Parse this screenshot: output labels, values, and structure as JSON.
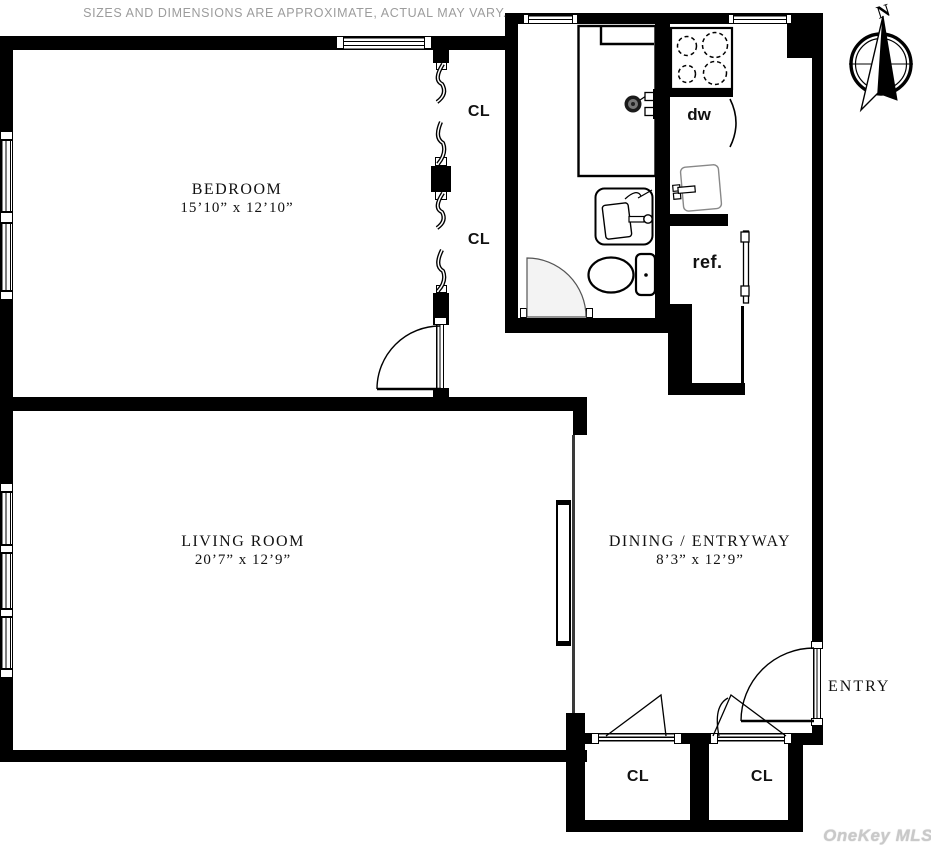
{
  "disclaimer": "SIZES AND DIMENSIONS ARE APPROXIMATE, ACTUAL MAY VARY.",
  "rooms": {
    "bedroom": {
      "name": "BEDROOM",
      "dimensions": "15’10” x 12’10”"
    },
    "living": {
      "name": "LIVING ROOM",
      "dimensions": "20’7” x 12’9”"
    },
    "dining": {
      "name": "DINING / ENTRYWAY",
      "dimensions": "8’3” x 12’9”"
    }
  },
  "closets": {
    "upper_1": "CL",
    "upper_2": "CL",
    "lower_left": "CL",
    "lower_right": "CL"
  },
  "kitchen": {
    "dishwasher": "dw",
    "refrigerator": "ref."
  },
  "entry_label": "ENTRY",
  "compass_north": "N",
  "watermark": "OneKey MLS",
  "colors": {
    "wall": "#000000",
    "background": "#ffffff",
    "muted_text": "#9c9c9c",
    "watermark": "#c9c9c9",
    "door_swing_fill": "#f3f3f3"
  }
}
